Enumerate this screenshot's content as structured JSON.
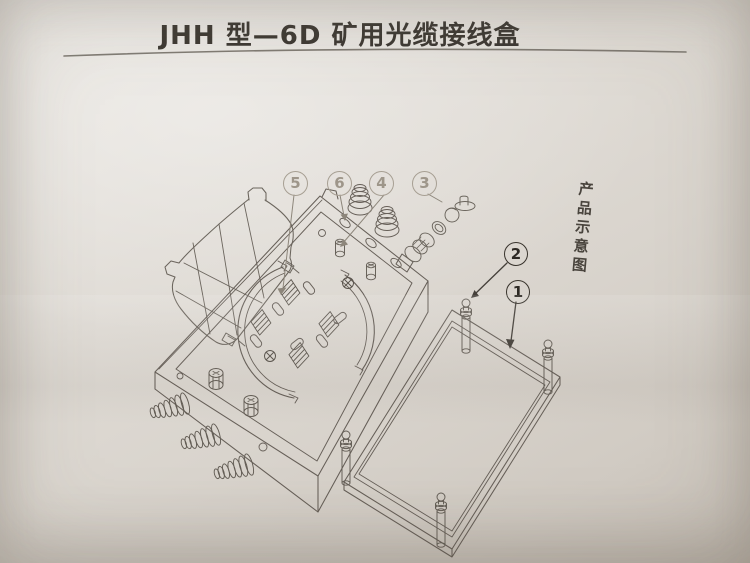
{
  "page": {
    "title": "JHH 型—6D 矿用光缆接线盒",
    "side_caption": "产品示意图"
  },
  "callouts": [
    {
      "label": "5"
    },
    {
      "label": "6"
    },
    {
      "label": "4"
    },
    {
      "label": "3"
    },
    {
      "label": "2"
    },
    {
      "label": "1"
    }
  ],
  "colors": {
    "paper": "#ddd8d1",
    "ink": "#6b655d",
    "ink_dark": "#45403a",
    "callout_faint": "#a79f93",
    "callout_dark": "#38332c"
  }
}
